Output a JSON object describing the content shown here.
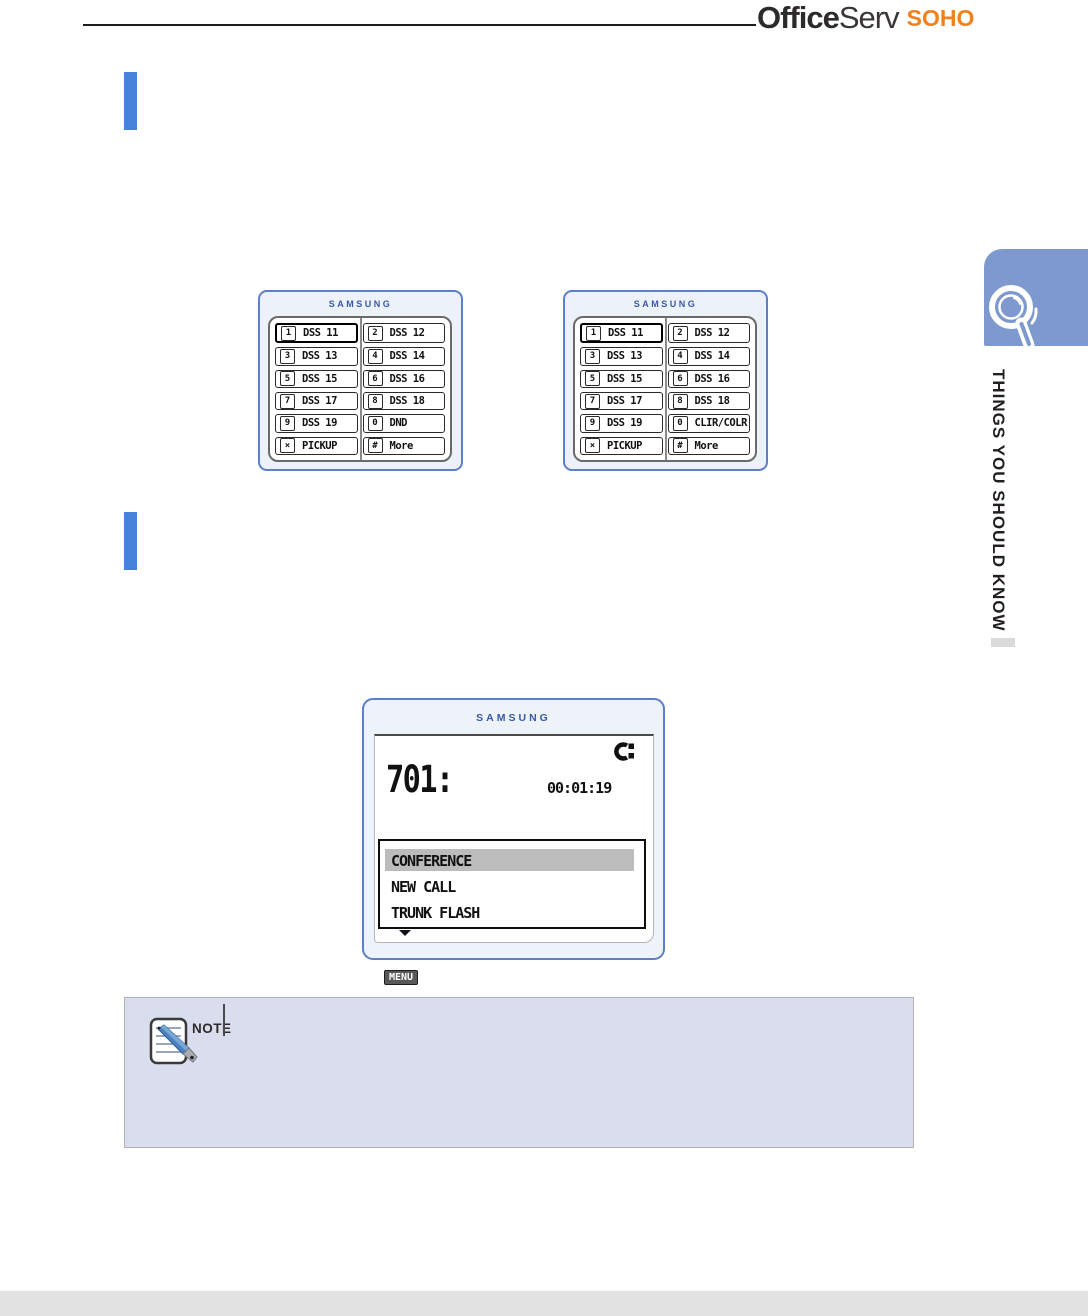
{
  "header": {
    "logo_office": "Office",
    "logo_serv": "Serv",
    "logo_soho": "SOHO"
  },
  "side_tab": {
    "label": "THINGS YOU SHOULD KNOW",
    "icon": "magnifier-icon"
  },
  "panels": [
    {
      "brand": "SAMSUNG",
      "buttons": [
        {
          "key": "1",
          "label": "DSS 11",
          "highlight": true
        },
        {
          "key": "2",
          "label": "DSS 12"
        },
        {
          "key": "3",
          "label": "DSS 13"
        },
        {
          "key": "4",
          "label": "DSS 14"
        },
        {
          "key": "5",
          "label": "DSS 15"
        },
        {
          "key": "6",
          "label": "DSS 16"
        },
        {
          "key": "7",
          "label": "DSS 17"
        },
        {
          "key": "8",
          "label": "DSS 18"
        },
        {
          "key": "9",
          "label": "DSS 19"
        },
        {
          "key": "0",
          "label": "DND"
        },
        {
          "key": "×",
          "label": "PICKUP"
        },
        {
          "key": "#",
          "label": "More"
        }
      ]
    },
    {
      "brand": "SAMSUNG",
      "buttons": [
        {
          "key": "1",
          "label": "DSS 11",
          "highlight": true
        },
        {
          "key": "2",
          "label": "DSS 12"
        },
        {
          "key": "3",
          "label": "DSS 13"
        },
        {
          "key": "4",
          "label": "DSS 14"
        },
        {
          "key": "5",
          "label": "DSS 15"
        },
        {
          "key": "6",
          "label": "DSS 16"
        },
        {
          "key": "7",
          "label": "DSS 17"
        },
        {
          "key": "8",
          "label": "DSS 18"
        },
        {
          "key": "9",
          "label": "DSS 19"
        },
        {
          "key": "0",
          "label": "CLIR/COLR"
        },
        {
          "key": "×",
          "label": "PICKUP"
        },
        {
          "key": "#",
          "label": "More"
        }
      ]
    }
  ],
  "phone_display": {
    "brand": "SAMSUNG",
    "station": "701:",
    "timer": "00:01:19",
    "call_icon": "handset-in-use-icon",
    "menu_items": [
      {
        "label": "CONFERENCE",
        "selected": true
      },
      {
        "label": "NEW CALL"
      },
      {
        "label": "TRUNK FLASH"
      }
    ],
    "menu_tag": "MENU"
  },
  "note": {
    "label": "NOTE",
    "icon": "note-pencil-icon"
  },
  "colors": {
    "accent_blue": "#4483d9",
    "panel_border_blue": "#5b7fc8",
    "tab_blue": "#7d99ce",
    "brand_blue": "#3a58a8",
    "soho_orange": "#f0821e",
    "note_bg": "#d9ddee",
    "menu_highlight": "#bcbcbc",
    "footer_gray": "#e2e2e2"
  }
}
